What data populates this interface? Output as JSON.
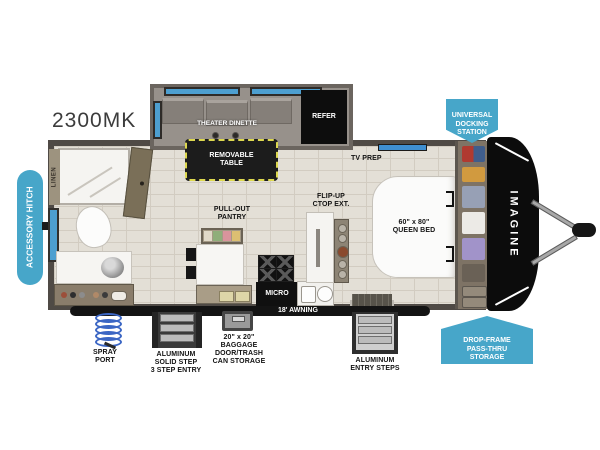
{
  "title": {
    "model": "2300MK",
    "brand": "IMAGINE"
  },
  "callouts": {
    "accessory_hitch": "ACCESSORY HITCH",
    "universal_docking": "UNIVERSAL\nDOCKING\nSTATION",
    "drop_frame": "DROP-FRAME\nPASS-THRU\nSTORAGE",
    "spray_port": "SPRAY\nPORT",
    "solid_step": "ALUMINUM\nSOLID STEP\n3 STEP ENTRY",
    "baggage": "20\" x 20\"\nBAGGAGE\nDOOR/TRASH\nCAN STORAGE",
    "entry_steps": "ALUMINUM\nENTRY STEPS",
    "awning": "18' AWNING"
  },
  "interior": {
    "theater_dinette": "THEATER DINETTE",
    "refer": "REFER",
    "removable_table": "REMOVABLE\nTABLE",
    "tv_prep": "TV PREP",
    "flip_up": "FLIP-UP\nCTOP EXT.",
    "queen_bed": "60\" x 80\"\nQUEEN BED",
    "pantry": "PULL-OUT\nPANTRY",
    "micro": "MICRO",
    "linen": "LINEN"
  },
  "colors": {
    "badge_blue": "#47a6c9",
    "window_blue": "#4d9fd0",
    "wall_dark": "#4f4a45",
    "floor_tile": "#e3dfd6",
    "callout_black": "#161616",
    "table_dash_yellow": "#ddd84f"
  }
}
